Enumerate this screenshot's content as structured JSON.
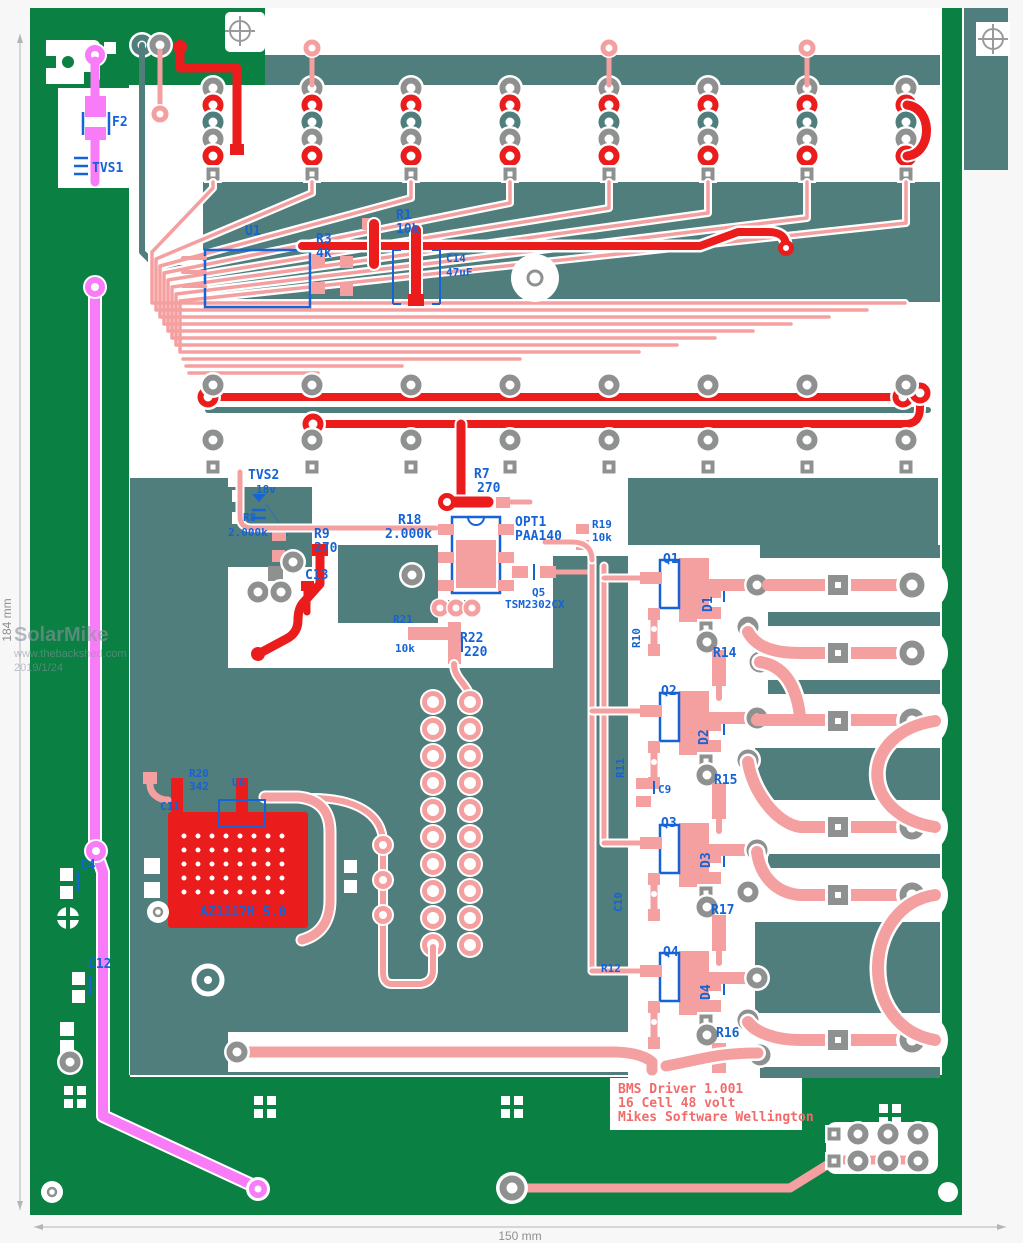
{
  "rulers": {
    "width_label": "150 mm",
    "height_label": "184 mm"
  },
  "watermark": {
    "line1": "SolarMike",
    "line2": "www.thebackshed.com",
    "line3": "2019/1/24"
  },
  "title_block": {
    "line1": "BMS Driver 1.001",
    "line2": "16 Cell 48 volt",
    "line3": "Mikes Software Wellington"
  },
  "colors": {
    "board_green": "#0a8043",
    "copper_pour_teal": "#4f7e7d",
    "bare_substrate": "#ffffff",
    "trace_salmon": "#f5a0a0",
    "trace_red": "#ea1c1c",
    "trace_magenta": "#f87cf8",
    "pad_gray": "#8f9191",
    "silkscreen_blue": "#1563d5",
    "silkscreen_red": "#f26b6b",
    "watermark_gray": "#8a93a0",
    "page_background": "#f7f7f7"
  },
  "silkscreen": {
    "f2": "F2",
    "tvs1": "TVS1",
    "u1": "U1",
    "r3": "R3",
    "r3_val": "4k",
    "r1": "R1",
    "r1_val": "10k",
    "c14": "C14",
    "c14_val": "47uF",
    "tvs2": "TVS2",
    "tvs2_val": "18v",
    "r8": "R8",
    "r8_val": "2.000k",
    "r9": "R9",
    "r9_val": "270",
    "r7": "R7",
    "r7_val": "270",
    "r18": "R18",
    "r18_val": "2.000k",
    "opt1": "OPT1",
    "opt1_val": "PAA140",
    "r19": "R19",
    "r19_val": "10k",
    "q5": "Q5",
    "q5_val": "TSM2302CX",
    "c13": "C13",
    "r21": "R21",
    "r21_val": "10k",
    "r22": "R22",
    "r22_val": "220",
    "q1": "Q1",
    "q2": "Q2",
    "q3": "Q3",
    "q4": "Q4",
    "d1": "D1",
    "d2": "D2",
    "d3": "D3",
    "d4": "D4",
    "r14": "R14",
    "r15": "R15",
    "r17": "R17",
    "r16": "R16",
    "c9": "C9",
    "r10": "R10",
    "r11": "R11",
    "c10": "C10",
    "r12": "R12",
    "r20": "R20",
    "r20_val": "342",
    "u6": "U6",
    "c11": "C11",
    "az_regulator": "AZ1117H 5.0",
    "c4": "C4",
    "c12": "C12"
  }
}
